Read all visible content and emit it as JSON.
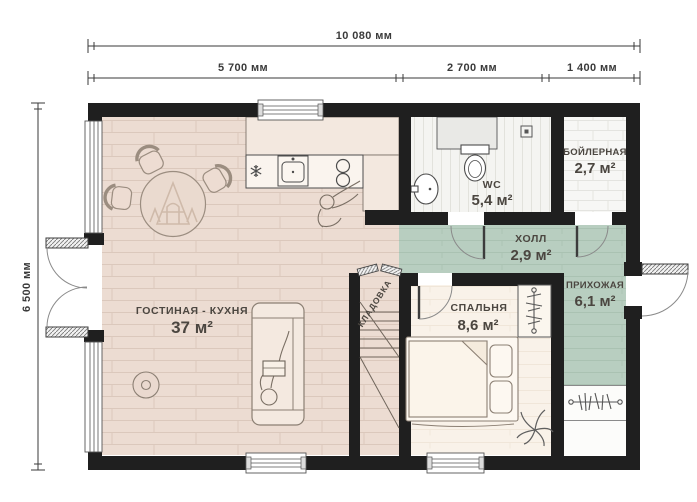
{
  "plan_title": "floor-plan-first-level",
  "dimensions": {
    "total_width": "10 080 мм",
    "segments": [
      {
        "label": "5 700 мм"
      },
      {
        "label": "2 700 мм"
      },
      {
        "label": "1 400 мм"
      }
    ],
    "height": "6 500 мм"
  },
  "rooms": {
    "living": {
      "name": "ГОСТИНАЯ - КУХНЯ",
      "area": "37 м²"
    },
    "wc": {
      "name": "WC",
      "area": "5,4 м²"
    },
    "boiler": {
      "name": "БОЙЛЕРНАЯ",
      "area": "2,7 м²"
    },
    "hall": {
      "name": "ХОЛЛ",
      "area": "2,9 м²"
    },
    "entry": {
      "name": "ПРИХОЖАЯ",
      "area": "6,1 м²"
    },
    "bedroom": {
      "name": "СПАЛЬНЯ",
      "area": "8,6 м²"
    },
    "storage": {
      "name": "КЛАДОВКА"
    }
  },
  "icons": {
    "fridge": "snowflake",
    "stove": "two-burners",
    "kitchen_sink": "basin",
    "toilet": "toilet",
    "washbasin": "oval-basin",
    "shower_drain": "drain-square",
    "bedroom_wardrobe": "hanger-rail-vertical",
    "entry_closet": "hanger-rail-horizontal",
    "plant": "plant-leaves",
    "table_logo": "a-frame-cabin-watermark"
  },
  "colors": {
    "wall": "#1f1f1f",
    "living_floor": "#ecdcd2",
    "hall_floor": "#b8cec0",
    "bedroom_floor": "#f9f2e9",
    "wc_floor": "#f4f4f1",
    "boiler_floor": "#f7f7f5",
    "dimension_ink": "#3a3a3a",
    "label_ink": "#4b4640",
    "furniture_ink": "#8b7f73",
    "fixture_ink": "#4c4c4c"
  }
}
